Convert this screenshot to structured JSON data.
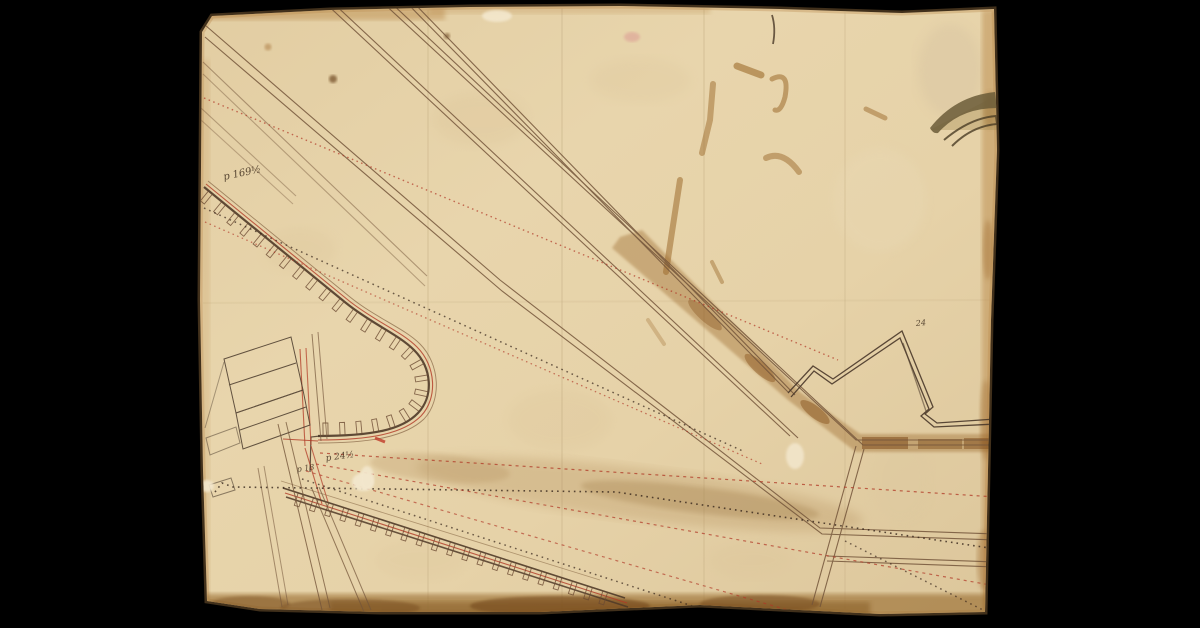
{
  "drawing": {
    "annotations": {
      "a1": {
        "text": "p 169½"
      },
      "a2": {
        "text": "p 24½"
      },
      "a3": {
        "text": "p 18"
      },
      "a4": {
        "text": "24"
      }
    },
    "colors": {
      "background": "#000000",
      "paper": "#e6d2a8",
      "paper_light": "#eedebb",
      "edge_stain": "#a9793f",
      "bottom_stain": "#9c7136",
      "ink": "#74553a",
      "dark_ink": "#4a382a",
      "red_ink": "#b23a26",
      "canal_wash": "#9c6a2e",
      "rust_mark": "#9c6a2c"
    }
  }
}
